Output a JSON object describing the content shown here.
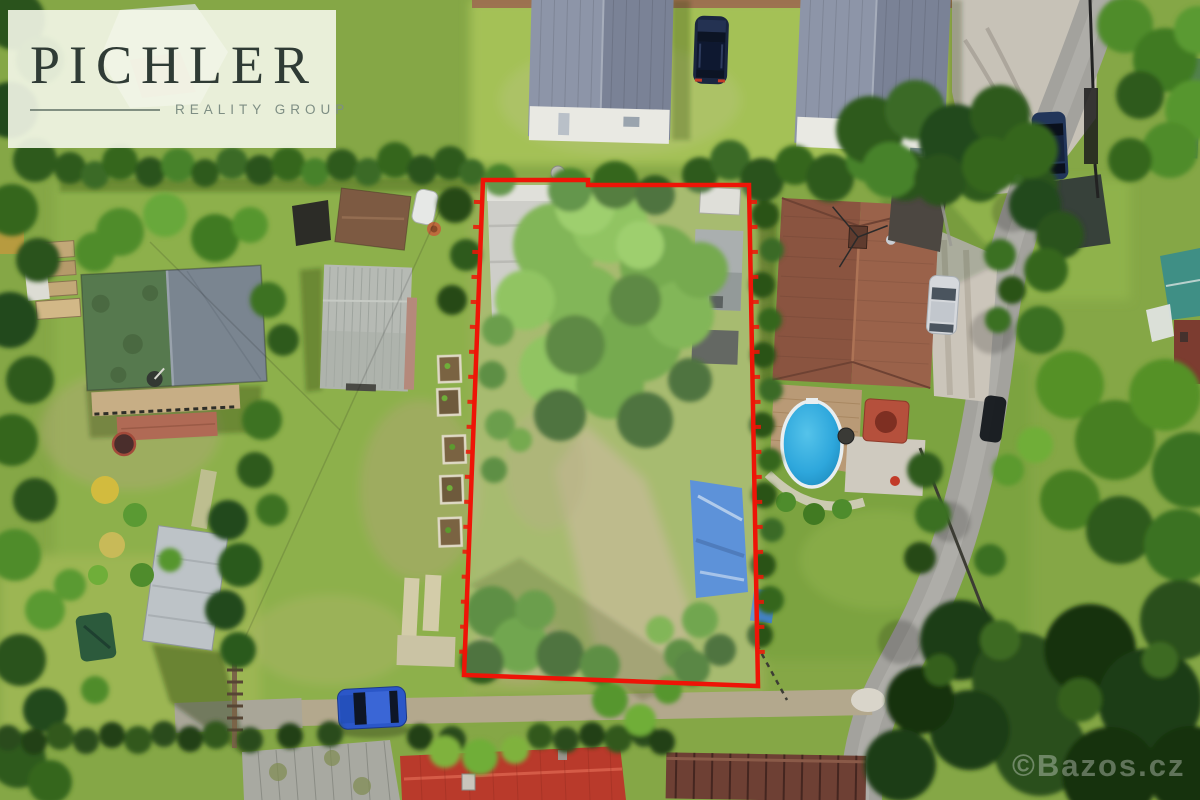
{
  "image": {
    "kind": "aerial-drone-photo",
    "description": "Top-down drone photograph of allotment gardens; one grassy overgrown plot is outlined in red as the advertised property",
    "width": 1200,
    "height": 800
  },
  "logo": {
    "brand": "PICHLER",
    "tagline": "REALITY GROUP",
    "brand_color": "#2f3b35",
    "tagline_color": "#7e8e84",
    "background": "rgba(244,247,233,0.9)"
  },
  "watermark": {
    "text": "©Bazos.cz",
    "color": "rgba(255,255,255,0.32)"
  },
  "boundary": {
    "points": "483,180 588,180 588,185 749,185 758,686 464,675",
    "stroke": "#ee1407",
    "fill": "rgba(255,255,255,0.16)"
  },
  "palette": {
    "boundary_red": "#ee1407",
    "lawn_green": "#85a746",
    "canopy_green": "#5c9a2f",
    "dark_tree_green": "#24481a",
    "roof_brown": "#8a5440",
    "mobile_home_roof_gray": "#8d95a8",
    "pool_blue": "#2ea7dc",
    "road_gray": "#a3a29d",
    "red_roof": "#b93a2b"
  },
  "scene": {
    "objects": [
      "outlined-land-plot",
      "mobile-homes",
      "suv-on-lawn",
      "parking-pad-car",
      "brown-roof-house",
      "gravel-driveway",
      "silver-car",
      "wooden-deck",
      "above-ground-pool",
      "hot-tub",
      "left-cottage",
      "gray-barn",
      "brown-shed",
      "raised-garden-beds",
      "bottom-left-shed",
      "green-tarp",
      "stepping-stones",
      "blue-hatchback",
      "dirt-lane",
      "asphalt-road",
      "red-tile-roof",
      "corrugated-roof",
      "plank-fence",
      "blue-tarp-shelter",
      "tree-canopy"
    ]
  }
}
